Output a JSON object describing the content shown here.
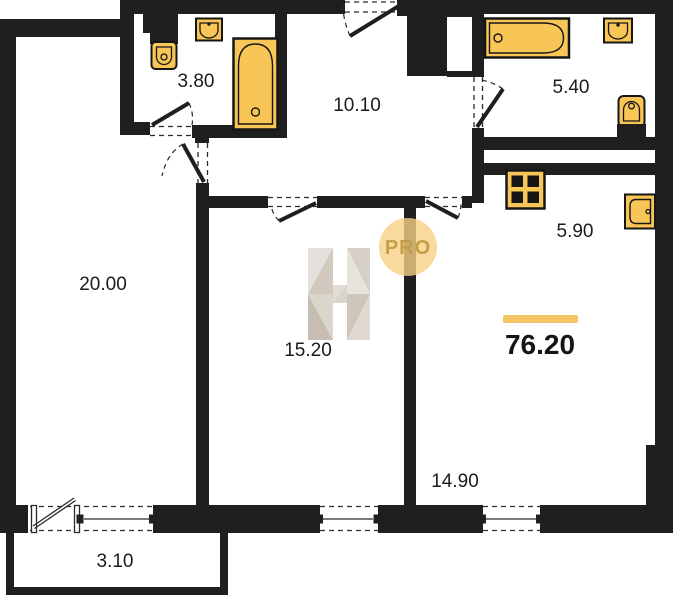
{
  "watermark": {
    "letter": "H",
    "badge": "PRO"
  },
  "total_area": {
    "value": "76.20"
  },
  "rooms": [
    {
      "name": "bedroom",
      "area": "20.00"
    },
    {
      "name": "ensuite-bathroom",
      "area": "3.80"
    },
    {
      "name": "hallway",
      "area": "10.10"
    },
    {
      "name": "bathroom",
      "area": "5.40"
    },
    {
      "name": "kitchen",
      "area": "5.90"
    },
    {
      "name": "bedroom-2",
      "area": "15.20"
    },
    {
      "name": "living-room",
      "area": "14.90"
    },
    {
      "name": "balcony",
      "area": "3.10"
    }
  ],
  "colors": {
    "wall": "#1f1f1f",
    "fixture": "#f8c557",
    "accent_bar": "#f4c666",
    "watermark_circle": "#f5d183"
  }
}
